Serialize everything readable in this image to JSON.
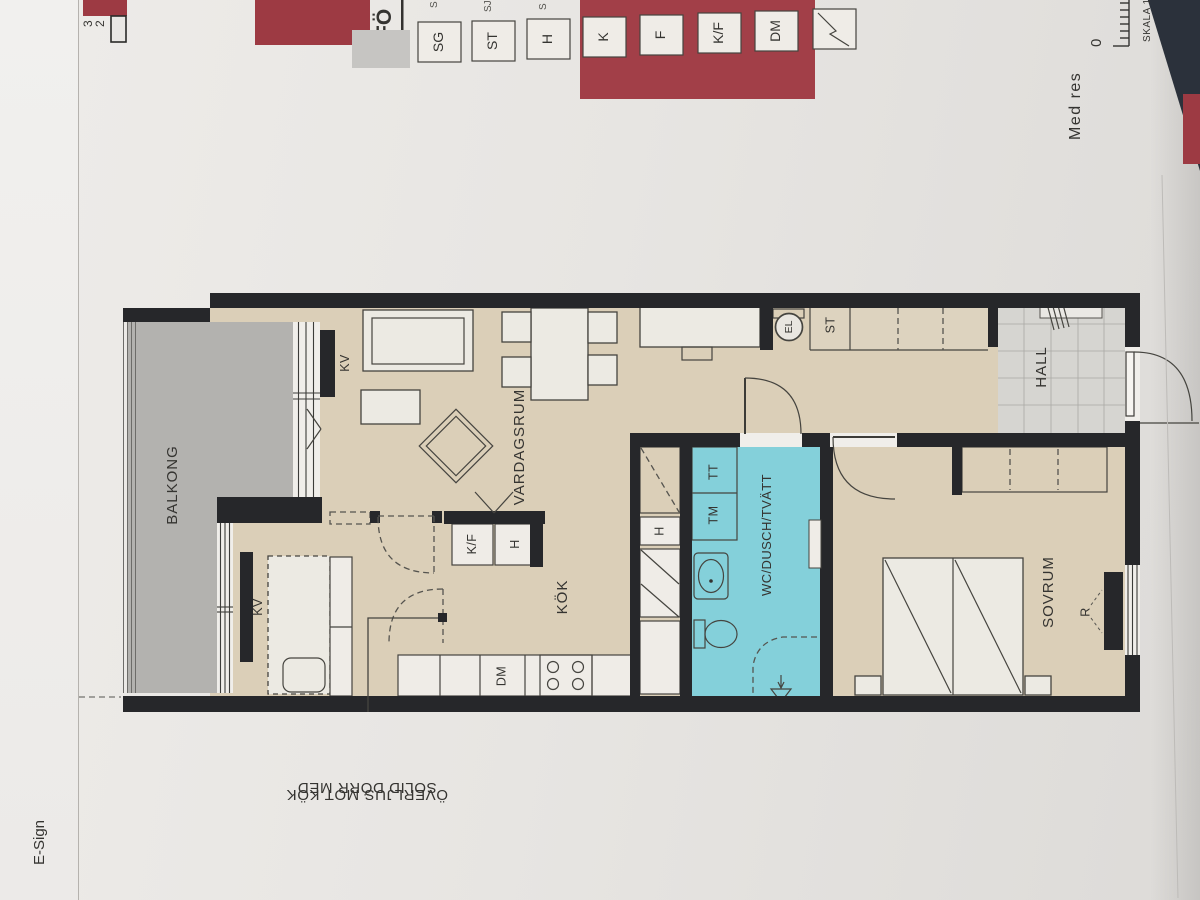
{
  "app": {
    "label": "E-Sign"
  },
  "header": {
    "corner_digits": [
      "3",
      "2"
    ]
  },
  "legend": {
    "title_partial": "FÖ",
    "items": [
      "SG",
      "ST",
      "H",
      "K",
      "F",
      "K/F",
      "DM"
    ],
    "symbol_item": "diagonal-line-box",
    "fragments": [
      "S",
      "SJ",
      "S"
    ]
  },
  "footer": {
    "disclaimer_partial": "Med res",
    "zero": "0",
    "scale_partial": "SKALA 1"
  },
  "plan": {
    "rooms": {
      "balcony": "BALKONG",
      "living": "VARDAGSRUM",
      "kitchen": "KÖK",
      "bathroom": "WC/DUSCH/TVÄTT",
      "bedroom": "SOVRUM",
      "hall": "HALL"
    },
    "fixtures": {
      "kv": "KV",
      "kf": "K/F",
      "h": "H",
      "dm": "DM",
      "tm": "TM",
      "tt": "TT",
      "st": "ST",
      "el": "EL",
      "r": "R"
    },
    "annotation": {
      "line1": "SOLID DÖRR MED",
      "line2": "ÖVERLJUS MOT KÖK"
    }
  },
  "colors": {
    "paper": "#e7e5e2",
    "wall": "#26272a",
    "floor": "#dbcfb8",
    "balcony": "#b3b2af",
    "bath": "#84d0da",
    "hall_tile": "#d6d5d1",
    "accent_red": "#9d3a43",
    "app_strip": "#f0efed",
    "dark_corner": "#2b313b"
  }
}
